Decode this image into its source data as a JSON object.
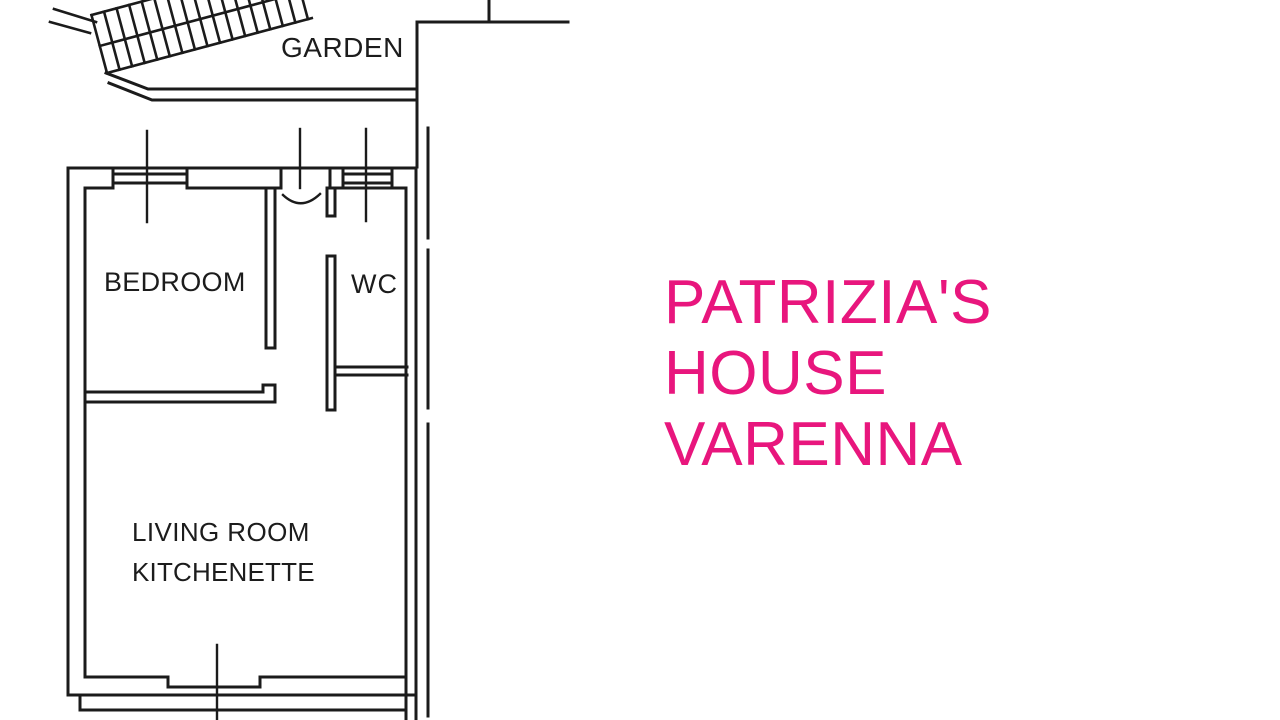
{
  "floor_plan": {
    "ink_color": "#1b1b1b",
    "labels": {
      "garden": "GARDEN",
      "bedroom": "BEDROOM",
      "wc": "WC",
      "living_room": "LIVING ROOM",
      "kitchenette": "KITCHENETTE"
    }
  },
  "title": {
    "color": "#e8167d",
    "line1": "PATRIZIA'S",
    "line2": "HOUSE",
    "line3": "VARENNA"
  }
}
